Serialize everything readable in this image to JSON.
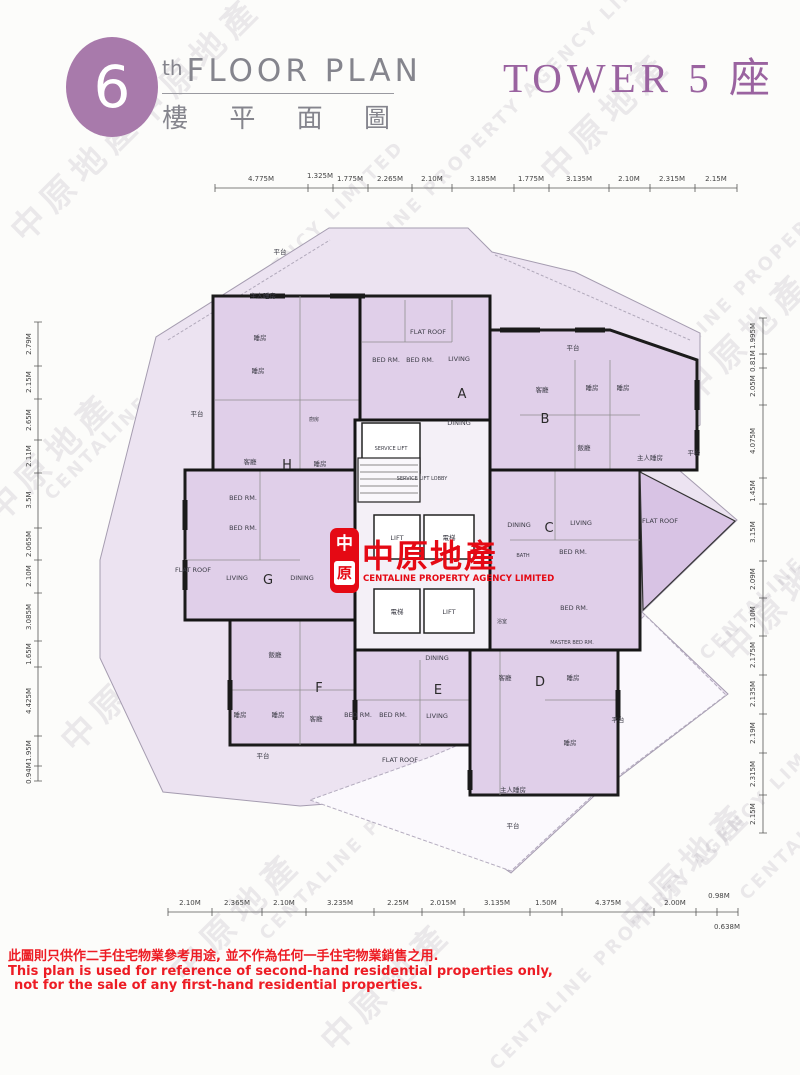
{
  "header": {
    "floor_number": "6",
    "floor_suffix": "th",
    "title_en": "FLOOR PLAN",
    "title_zh_chars": [
      "樓",
      "平",
      "面",
      "圖"
    ],
    "tower_label": "TOWER 5 座"
  },
  "logo": {
    "seal_top": "中",
    "seal_bottom": "原",
    "name_zh": "中原地產",
    "name_en": "CENTALINE PROPERTY AGENCY LIMITED"
  },
  "watermark": {
    "zh": "中原地產",
    "en": "CENTALINE PROPERTY AGENCY LIMITED"
  },
  "rulers": {
    "top": [
      "4.775M",
      "1.325M",
      "1.775M",
      "2.265M",
      "2.10M",
      "3.185M",
      "1.775M",
      "3.135M",
      "2.10M",
      "2.315M",
      "2.15M"
    ],
    "bottom": [
      "2.10M",
      "2.365M",
      "2.10M",
      "3.235M",
      "2.25M",
      "2.015M",
      "3.135M",
      "1.50M",
      "4.375M",
      "2.00M",
      "0.98M"
    ],
    "bottom_extra": "0.638M",
    "left": [
      "2.79M",
      "2.15M",
      "2.65M",
      "2.11M",
      "3.5M",
      "2.065M",
      "2.10M",
      "3.085M",
      "1.65M",
      "4.425M",
      "1.95M",
      "0.94M"
    ],
    "right": [
      "1.995M",
      "0.81M",
      "2.05M",
      "4.075M",
      "1.45M",
      "3.15M",
      "2.09M",
      "2.10M",
      "2.175M",
      "2.135M",
      "2.19M",
      "2.315M",
      "2.15M"
    ]
  },
  "plan": {
    "terrace": "平台",
    "flat_roof": "FLAT ROOF",
    "bath_zh": "浴室",
    "bath_en": "BATH",
    "kitchen_zh": "廚房",
    "units": {
      "A": {
        "id": "A",
        "rooms": [
          "BED RM.",
          "BED RM.",
          "LIVING",
          "DINING"
        ]
      },
      "B": {
        "id": "B",
        "rooms": [
          "客廳",
          "睡房",
          "睡房",
          "飯廳",
          "主人睡房"
        ]
      },
      "C": {
        "id": "C",
        "rooms": [
          "DINING",
          "LIVING",
          "BED RM.",
          "BED RM.",
          "MASTER BED RM."
        ]
      },
      "D": {
        "id": "D",
        "rooms": [
          "客廳",
          "睡房",
          "睡房",
          "主人睡房"
        ]
      },
      "E": {
        "id": "E",
        "rooms": [
          "DINING",
          "BED RM.",
          "BED RM.",
          "LIVING"
        ]
      },
      "F": {
        "id": "F",
        "rooms": [
          "飯廳",
          "睡房",
          "睡房",
          "客廳"
        ]
      },
      "G": {
        "id": "G",
        "rooms": [
          "BED RM.",
          "BED RM.",
          "LIVING",
          "DINING"
        ]
      },
      "H": {
        "id": "H",
        "rooms": [
          "主人睡房",
          "睡房",
          "睡房",
          "客廳",
          "睡房"
        ]
      }
    },
    "core": {
      "service_lift": "SERVICE LIFT",
      "lobby": "SERVICE LIFT LOBBY",
      "lift_a": "LIFT",
      "lift_b": "電梯",
      "lift_c": "電梯",
      "lift_d": "LIFT"
    }
  },
  "footer": {
    "line1": "此圖則只供作二手住宅物業參考用途, 並不作為任何一手住宅物業銷售之用.",
    "line2": "This plan is used for reference of second-hand residential properties only,",
    "line3": "not for the sale of any first-hand residential properties."
  }
}
